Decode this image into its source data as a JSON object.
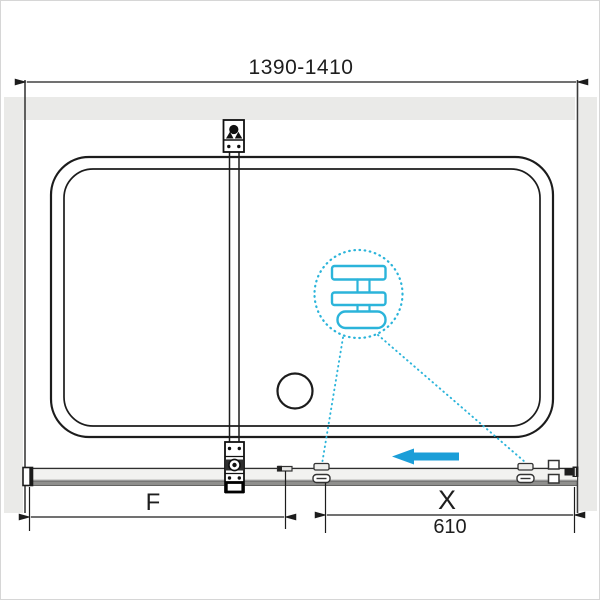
{
  "diagram": {
    "type": "technical-drawing",
    "subject": "Bathtub sliding shower-screen installation diagram (plan view)",
    "dimensions": {
      "overall_width_range": "1390-1410",
      "fixed_panel_label": "F",
      "sliding_door_label": "X",
      "sliding_door_width": "610"
    },
    "annotations": {
      "slide_direction": "left",
      "detail_callout": "roller-carriage-magnified-detail"
    },
    "colors": {
      "line_dark": "#1c1c1c",
      "wall_gray": "#eaeae8",
      "rail_light": "#f2f2f0",
      "rail_dark": "#8f8f8d",
      "accent_blue": "#1b9ed8",
      "detail_cyan": "#2bb4da"
    }
  }
}
